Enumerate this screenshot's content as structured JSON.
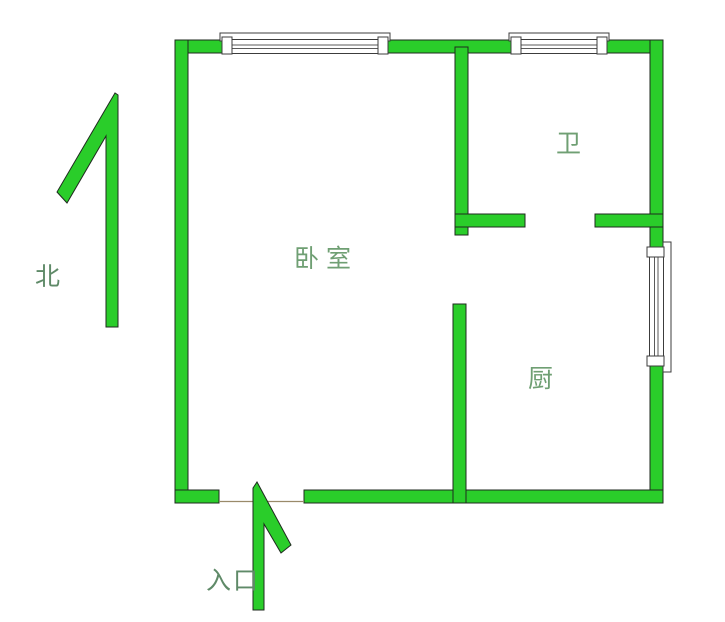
{
  "floorplan": {
    "compass": {
      "label": "北"
    },
    "entrance": {
      "label": "入口"
    },
    "rooms": [
      {
        "id": "bedroom",
        "label": "卧室"
      },
      {
        "id": "bathroom",
        "label": "卫"
      },
      {
        "id": "kitchen",
        "label": "厨"
      }
    ],
    "icons": {
      "north_arrow": "north-arrow-icon",
      "entrance_arrow": "entrance-arrow-icon",
      "window": "window-icon"
    },
    "colors": {
      "wall_fill": "#2acd2a",
      "wall_outline": "#1f2a1f",
      "room_label_text": "#6f9f73",
      "compass_label_text": "#5f8a68",
      "window_fill": "#ffffff",
      "window_frame": "#3c3c3c",
      "threshold_line": "#9a8a6a",
      "background": "#ffffff"
    }
  }
}
